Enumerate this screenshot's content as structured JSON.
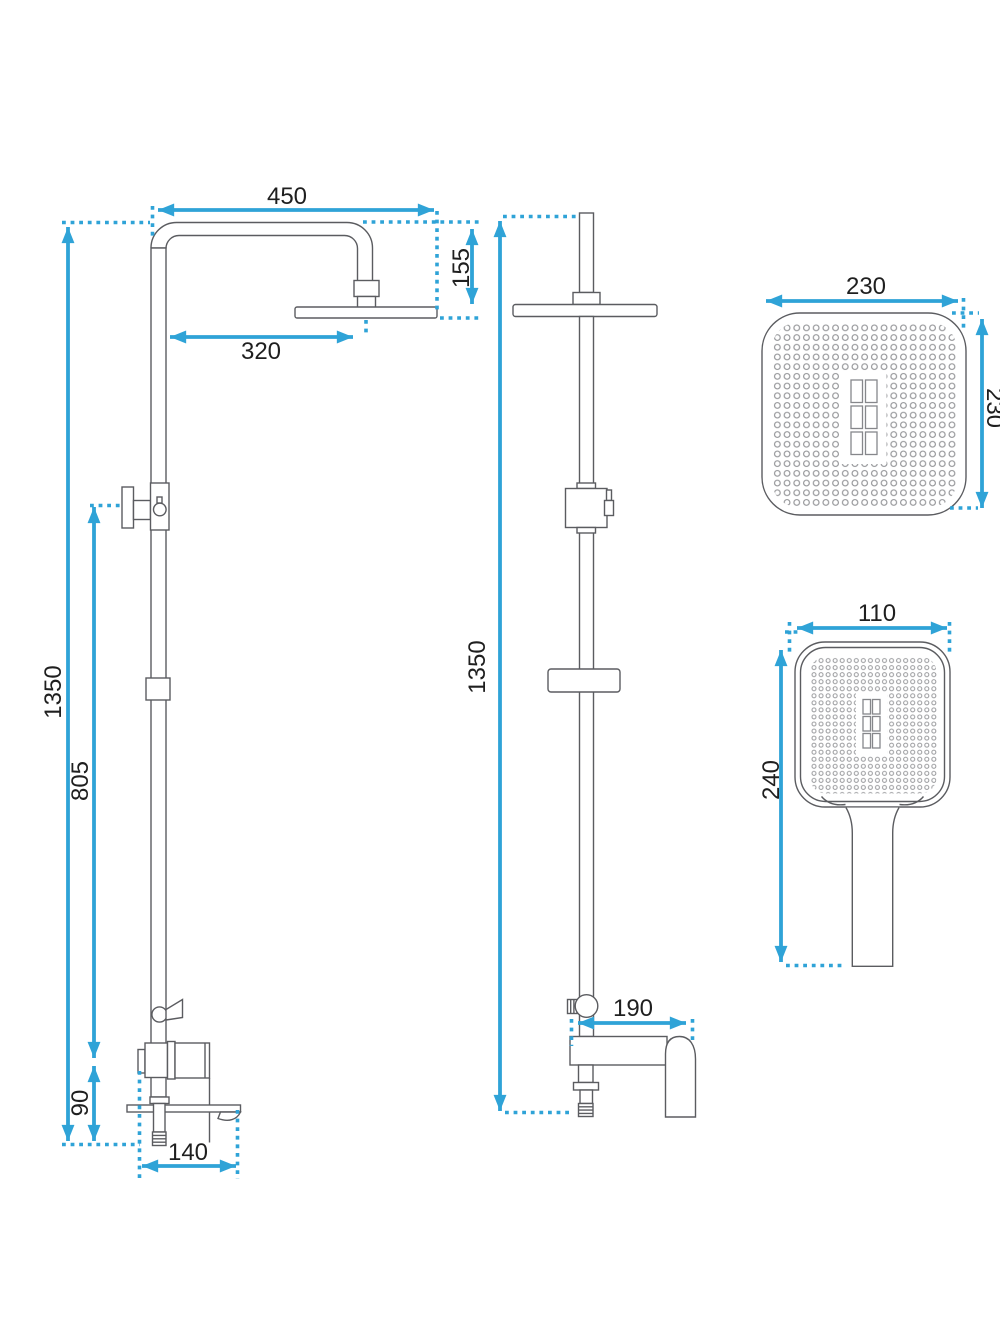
{
  "drawing": {
    "colors": {
      "dimension_blue": "#2fa3d7",
      "outline_gray": "#5b5c60",
      "label_black": "#1f1f1f",
      "background": "#ffffff"
    },
    "views": {
      "front": {
        "dims": {
          "arm_width": "450",
          "head_drop": "155",
          "head_reach": "320",
          "total_height": "1350",
          "bracket_height": "805",
          "outlet_height": "90",
          "base_depth": "140"
        }
      },
      "side": {
        "dims": {
          "total_height": "1350",
          "spout_reach": "190"
        }
      },
      "head_top": {
        "dims": {
          "width": "230",
          "depth": "230"
        }
      },
      "hand": {
        "dims": {
          "width": "110",
          "length": "240"
        }
      }
    }
  }
}
